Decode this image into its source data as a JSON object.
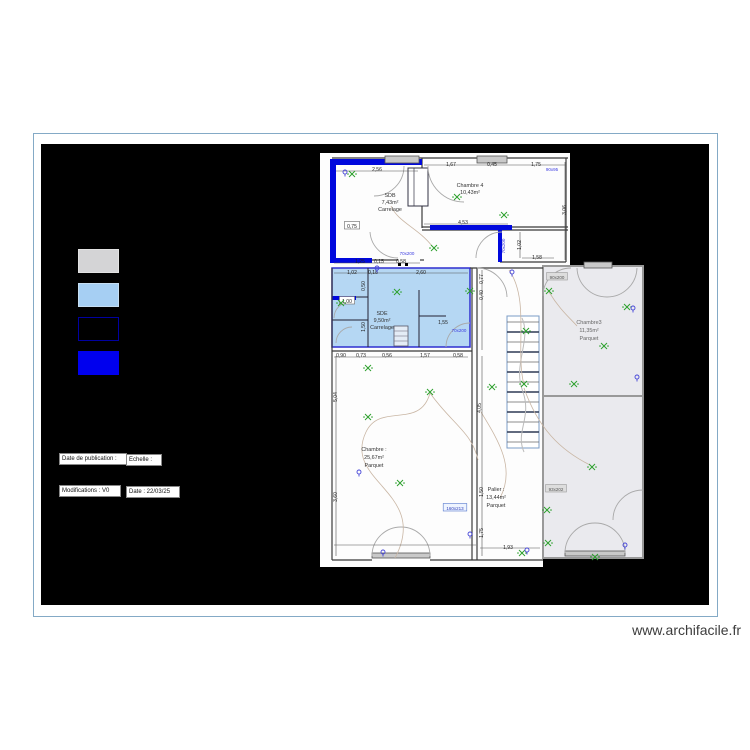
{
  "watermark": "www.archifacile.fr",
  "legend": {
    "swatches": [
      {
        "name": "existing-wall",
        "color": "#d4d4d6",
        "border": "#e2e2e2"
      },
      {
        "name": "highlight-room",
        "color": "#a6cff3",
        "border": "#c6def2"
      },
      {
        "name": "demolished-wall",
        "color": "#000000",
        "border": "#0000a0"
      },
      {
        "name": "new-wall",
        "color": "#0000ee",
        "border": "#0000ee"
      }
    ]
  },
  "info": {
    "publication_label": "Date de publication :",
    "scale_label": "Echelle :",
    "modifications_label": "Modifications : V0",
    "date_label": "Date : 22/03/25"
  },
  "rooms": {
    "sdb": {
      "name": "SDB",
      "area": "7,43m²",
      "floor": "Carrelage"
    },
    "chambre4": {
      "name": "Chambre 4",
      "area": "10,43m²",
      "floor": ""
    },
    "sde": {
      "name": "SDE",
      "area": "9,50m²",
      "floor": "Carrelage"
    },
    "chambre1": {
      "name": "Chambre :",
      "area": "25,67m²",
      "floor": "Parquet"
    },
    "palier": {
      "name": "Palier :",
      "area": "13,44m²",
      "floor": "Parquet"
    },
    "chambre3": {
      "name": "Chambre3",
      "area": "11,35m²",
      "floor": "Parquet"
    }
  },
  "plan": {
    "accent_blue": "#0008dd",
    "room_fill_blue": "#b5d7f3",
    "room_fill_gray": "#eaeaee",
    "dimensions": [
      {
        "x": 377,
        "y": 169,
        "t": "2,56"
      },
      {
        "x": 352,
        "y": 226,
        "t": "0,75",
        "s": "boxed"
      },
      {
        "x": 360,
        "y": 261,
        "t": "1,25"
      },
      {
        "x": 379,
        "y": 261,
        "t": "0,15"
      },
      {
        "x": 401,
        "y": 261,
        "t": "0,58"
      },
      {
        "x": 451,
        "y": 164,
        "t": "1,67"
      },
      {
        "x": 492,
        "y": 164,
        "t": "0,45"
      },
      {
        "x": 536,
        "y": 164,
        "t": "1,75"
      },
      {
        "x": 552,
        "y": 169,
        "t": "90x95",
        "s": "blue"
      },
      {
        "x": 463,
        "y": 222,
        "t": "4,53"
      },
      {
        "x": 564,
        "y": 210,
        "t": "3,06",
        "rot": -90
      },
      {
        "x": 519,
        "y": 245,
        "t": "1,02",
        "rot": -90
      },
      {
        "x": 537,
        "y": 257,
        "t": "1,58"
      },
      {
        "x": 503,
        "y": 246,
        "t": "70x200",
        "rot": -90,
        "s": "blue"
      },
      {
        "x": 407,
        "y": 253,
        "t": "70x200",
        "s": "blue"
      },
      {
        "x": 352,
        "y": 272,
        "t": "1,02"
      },
      {
        "x": 373,
        "y": 272,
        "t": "0,18"
      },
      {
        "x": 421,
        "y": 272,
        "t": "2,60"
      },
      {
        "x": 347,
        "y": 301,
        "t": "1,00",
        "s": "boxed"
      },
      {
        "x": 363,
        "y": 286,
        "t": "0,50",
        "rot": -90
      },
      {
        "x": 363,
        "y": 327,
        "t": "1,50",
        "rot": -90
      },
      {
        "x": 443,
        "y": 322,
        "t": "1,55"
      },
      {
        "x": 459,
        "y": 330,
        "t": "70x200",
        "s": "blue"
      },
      {
        "x": 341,
        "y": 355,
        "t": "0,90"
      },
      {
        "x": 361,
        "y": 355,
        "t": "0,73"
      },
      {
        "x": 387,
        "y": 355,
        "t": "0,56"
      },
      {
        "x": 425,
        "y": 355,
        "t": "1,57"
      },
      {
        "x": 458,
        "y": 355,
        "t": "0,58"
      },
      {
        "x": 335,
        "y": 397,
        "t": "5,04",
        "rot": -90
      },
      {
        "x": 335,
        "y": 497,
        "t": "3,60",
        "rot": -90
      },
      {
        "x": 481,
        "y": 279,
        "t": "0,77",
        "rot": -90
      },
      {
        "x": 481,
        "y": 295,
        "t": "0,40",
        "rot": -90
      },
      {
        "x": 479,
        "y": 408,
        "t": "4,05",
        "rot": -90
      },
      {
        "x": 481,
        "y": 492,
        "t": "1,50",
        "rot": -90
      },
      {
        "x": 481,
        "y": 533,
        "t": "1,75",
        "rot": -90
      },
      {
        "x": 455,
        "y": 508,
        "t": "160x213",
        "s": "blueBox"
      },
      {
        "x": 508,
        "y": 547,
        "t": "1,93"
      },
      {
        "x": 557,
        "y": 277,
        "t": "90x200",
        "s": "grayBox"
      },
      {
        "x": 556,
        "y": 489,
        "t": "93x202",
        "s": "grayBox"
      }
    ],
    "lights": [
      [
        352,
        174
      ],
      [
        457,
        197
      ],
      [
        504,
        215
      ],
      [
        434,
        248
      ],
      [
        397,
        292
      ],
      [
        341,
        303
      ],
      [
        470,
        291
      ],
      [
        549,
        291
      ],
      [
        627,
        307
      ],
      [
        604,
        346
      ],
      [
        526,
        331
      ],
      [
        524,
        384
      ],
      [
        574,
        384
      ],
      [
        368,
        368
      ],
      [
        430,
        392
      ],
      [
        368,
        417
      ],
      [
        400,
        483
      ],
      [
        492,
        387
      ],
      [
        592,
        467
      ],
      [
        547,
        510
      ],
      [
        548,
        543
      ],
      [
        522,
        553
      ],
      [
        595,
        557
      ]
    ],
    "sockets": [
      [
        345,
        172
      ],
      [
        377,
        268
      ],
      [
        512,
        272
      ],
      [
        633,
        308
      ],
      [
        637,
        377
      ],
      [
        359,
        472
      ],
      [
        383,
        552
      ],
      [
        527,
        550
      ],
      [
        625,
        545
      ],
      [
        470,
        534
      ]
    ]
  }
}
